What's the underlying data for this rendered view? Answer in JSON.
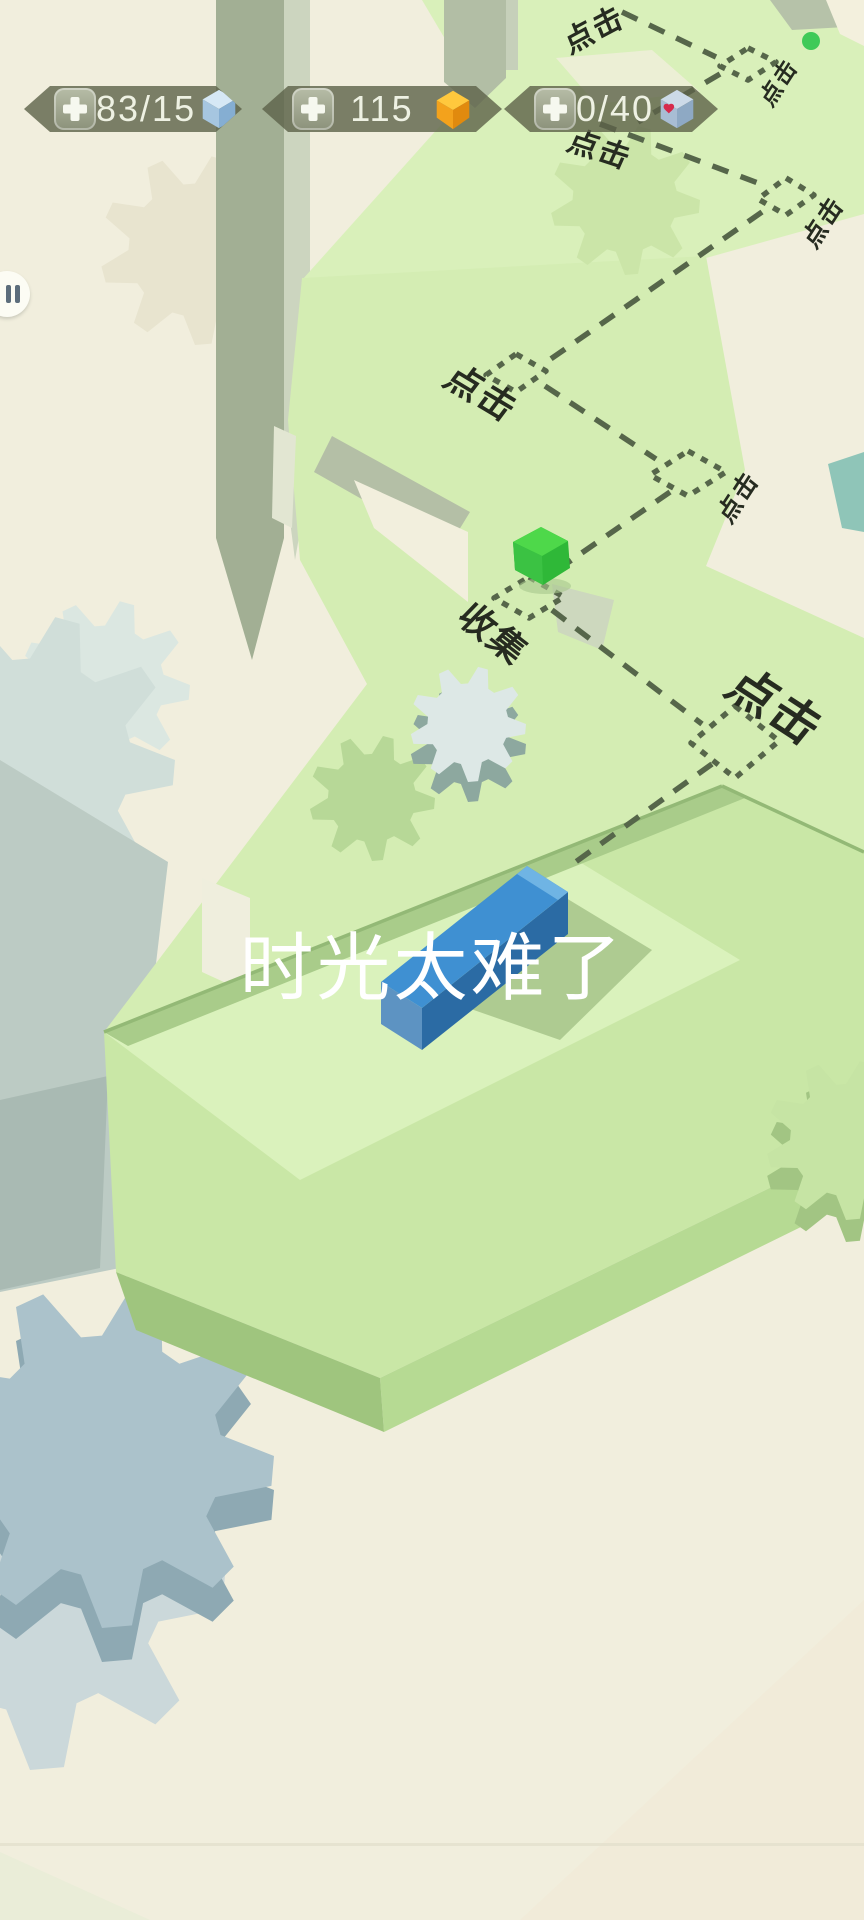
{
  "hud": {
    "counters": [
      {
        "id": "blocks",
        "value": "83/15",
        "icon": "blue-cube-icon",
        "add_button": "plus-icon"
      },
      {
        "id": "gold",
        "value": "115",
        "icon": "gold-gem-icon",
        "add_button": "plus-icon"
      },
      {
        "id": "lives",
        "value": "0/40",
        "icon": "heart-cube-icon",
        "add_button": "plus-icon"
      }
    ]
  },
  "pause": {
    "icon": "pause-icon"
  },
  "labels": {
    "tap1": "点击",
    "tap2": "点击",
    "tap3": "点击",
    "tap4": "点击",
    "tap5": "点击",
    "tap6": "点击",
    "tap7": "点击",
    "collect": "收集"
  },
  "banner": {
    "title": "时光太难了"
  },
  "colors": {
    "background_cream": "#f1eedd",
    "platform_green": "#d8efb8",
    "platform_green_deep": "#c9e7a6",
    "path_dash": "#56664a",
    "hud_badge": "#5d6249",
    "block_blue": "#3f90d2",
    "gem_green": "#3ec947",
    "start_dot_green": "#3fca58",
    "heart_red": "#d62a4c",
    "gold": "#f5a81c"
  }
}
